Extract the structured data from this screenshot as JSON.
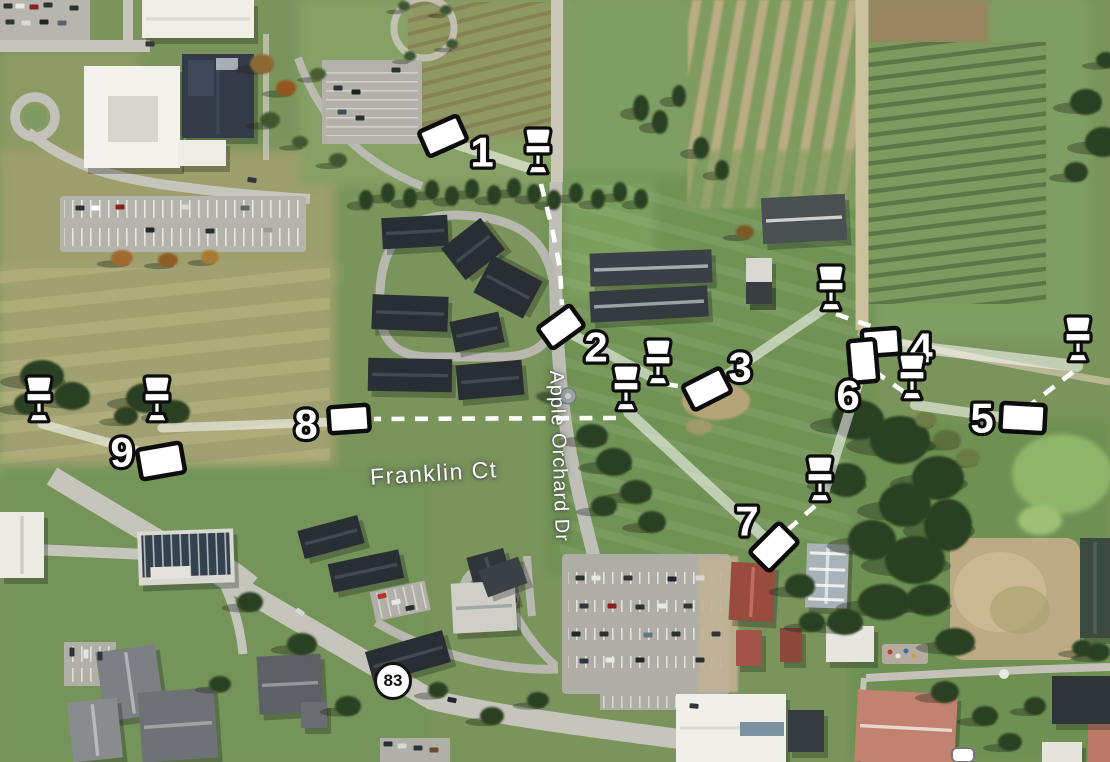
{
  "map": {
    "street_labels": [
      {
        "text": "Franklin Ct"
      },
      {
        "text": "Apple Orchard Dr"
      }
    ],
    "route_shield": {
      "text": "83"
    }
  },
  "course": {
    "hole_count": 9,
    "colors": {
      "marker_fill": "#ffffff",
      "marker_stroke": "#0c0c0c",
      "fairway": "rgba(255,255,255,0.55)",
      "walk": "#ffffff"
    },
    "holes": [
      {
        "label": "1",
        "tee": {
          "x": 443,
          "y": 136,
          "r": -24,
          "w": 42,
          "h": 27
        },
        "num": {
          "x": 482,
          "y": 152
        },
        "basket": {
          "x": 538,
          "y": 172
        },
        "fairway": [
          [
            449,
            142
          ],
          [
            535,
            170
          ]
        ],
        "walk": [
          [
            541,
            184
          ],
          [
            552,
            228
          ],
          [
            560,
            268
          ],
          [
            562,
            305
          ]
        ]
      },
      {
        "label": "2",
        "tee": {
          "x": 561,
          "y": 327,
          "r": -36,
          "w": 40,
          "h": 26
        },
        "num": {
          "x": 596,
          "y": 347
        },
        "basket": {
          "x": 658,
          "y": 383
        },
        "fairway": [
          [
            566,
            331
          ],
          [
            655,
            379
          ]
        ],
        "walk": [
          [
            665,
            384
          ],
          [
            691,
            388
          ]
        ]
      },
      {
        "label": "3",
        "tee": {
          "x": 707,
          "y": 389,
          "r": -27,
          "w": 42,
          "h": 27
        },
        "num": {
          "x": 740,
          "y": 367
        },
        "basket": {
          "x": 831,
          "y": 309
        },
        "fairway": [
          [
            712,
            385
          ],
          [
            828,
            306
          ]
        ],
        "walk": [
          [
            836,
            314
          ],
          [
            876,
            328
          ]
        ]
      },
      {
        "label": "4",
        "tee": {
          "x": 881,
          "y": 342,
          "r": -4,
          "w": 37,
          "h": 26
        },
        "num": {
          "x": 921,
          "y": 348
        },
        "basket": {
          "x": 1078,
          "y": 360
        },
        "fw_width": 12,
        "fairway": [
          [
            897,
            345
          ],
          [
            1077,
            366
          ]
        ],
        "walk": [
          [
            1073,
            372
          ],
          [
            1029,
            406
          ]
        ]
      },
      {
        "label": "5",
        "tee": {
          "x": 1023,
          "y": 418,
          "r": 3,
          "w": 44,
          "h": 28
        },
        "num": {
          "x": 982,
          "y": 418
        },
        "basket": {
          "x": 912,
          "y": 398
        },
        "fairway": [
          [
            999,
            417
          ],
          [
            915,
            405
          ]
        ],
        "walk": [
          [
            904,
            392
          ],
          [
            874,
            371
          ]
        ]
      },
      {
        "label": "6",
        "tee": {
          "x": 863,
          "y": 361,
          "r": 85,
          "w": 42,
          "h": 27
        },
        "num": {
          "x": 848,
          "y": 395
        },
        "basket": {
          "x": 820,
          "y": 500
        },
        "fairway": [
          [
            861,
            374
          ],
          [
            823,
            496
          ]
        ],
        "walk": [
          [
            815,
            506
          ],
          [
            783,
            534
          ]
        ]
      },
      {
        "label": "7",
        "tee": {
          "x": 774,
          "y": 547,
          "r": -45,
          "w": 42,
          "h": 28
        },
        "num": {
          "x": 747,
          "y": 521
        },
        "basket": {
          "x": 626,
          "y": 409
        },
        "fw_width": 11,
        "fairway": [
          [
            768,
            541
          ],
          [
            629,
            413
          ]
        ],
        "walk": [
          [
            616,
            418
          ],
          [
            374,
            419
          ]
        ]
      },
      {
        "label": "8",
        "tee": {
          "x": 349,
          "y": 419,
          "r": -4,
          "w": 40,
          "h": 26
        },
        "num": {
          "x": 306,
          "y": 424
        },
        "basket": {
          "x": 157,
          "y": 420
        },
        "fw_width": 9,
        "fairway": [
          [
            331,
            422
          ],
          [
            162,
            428
          ]
        ],
        "walk": []
      },
      {
        "label": "9",
        "tee": {
          "x": 161,
          "y": 461,
          "r": -10,
          "w": 44,
          "h": 30
        },
        "num": {
          "x": 122,
          "y": 452
        },
        "basket": {
          "x": 39,
          "y": 420
        },
        "fw_width": 9,
        "fairway": [
          [
            149,
            454
          ],
          [
            42,
            424
          ]
        ],
        "walk": []
      }
    ]
  }
}
